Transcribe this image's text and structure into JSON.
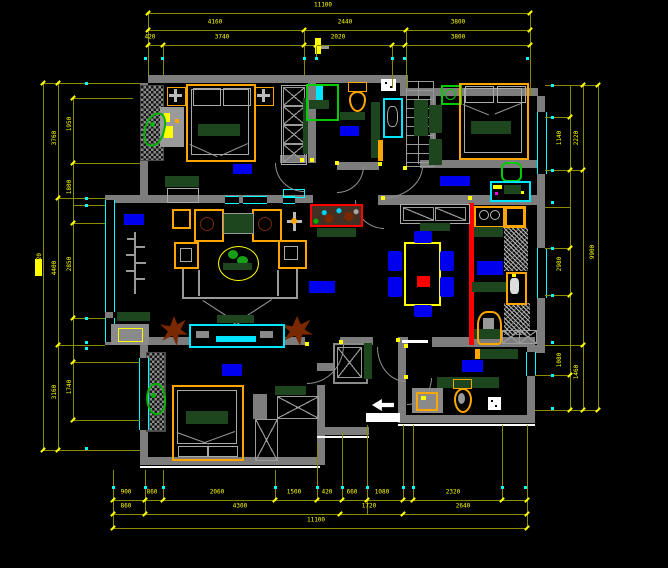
{
  "drawing": {
    "type": "residential floor plan (CAD)",
    "background": "#000000",
    "colors": {
      "wall": "#7d7d7d",
      "dimension_line": "#8a8a00",
      "dimension_text": "#ffff00",
      "window": "#00ffff",
      "furniture_frame": "#ffa500",
      "counter_green": "#1e461e",
      "label_block": "#0000ee",
      "accent_red": "#ff0000",
      "shower_green": "#00cc00",
      "chair_blue": "#0000ee",
      "plant_brown": "#7a2800"
    },
    "dimension_labels": [
      {
        "t": "11100",
        "x": 323,
        "y": 9,
        "v": false
      },
      {
        "t": "4160",
        "x": 215,
        "y": 26,
        "v": false
      },
      {
        "t": "2440",
        "x": 345,
        "y": 26,
        "v": false
      },
      {
        "t": "3800",
        "x": 458,
        "y": 26,
        "v": false
      },
      {
        "t": "420",
        "x": 150,
        "y": 41,
        "v": false
      },
      {
        "t": "3740",
        "x": 222,
        "y": 41,
        "v": false
      },
      {
        "t": "2020",
        "x": 338,
        "y": 41,
        "v": false
      },
      {
        "t": "3800",
        "x": 458,
        "y": 41,
        "v": false
      },
      {
        "t": "900",
        "x": 126,
        "y": 496,
        "v": false
      },
      {
        "t": "860",
        "x": 152,
        "y": 496,
        "v": false
      },
      {
        "t": "2060",
        "x": 217,
        "y": 496,
        "v": false
      },
      {
        "t": "1500",
        "x": 294,
        "y": 496,
        "v": false
      },
      {
        "t": "420",
        "x": 327,
        "y": 496,
        "v": false
      },
      {
        "t": "660",
        "x": 352,
        "y": 496,
        "v": false
      },
      {
        "t": "1080",
        "x": 382,
        "y": 496,
        "v": false
      },
      {
        "t": "2320",
        "x": 453,
        "y": 496,
        "v": false
      },
      {
        "t": "860",
        "x": 126,
        "y": 510,
        "v": false
      },
      {
        "t": "4300",
        "x": 240,
        "y": 510,
        "v": false
      },
      {
        "t": "1720",
        "x": 369,
        "y": 510,
        "v": false
      },
      {
        "t": "2640",
        "x": 463,
        "y": 510,
        "v": false
      },
      {
        "t": "11100",
        "x": 316,
        "y": 524,
        "v": false
      },
      {
        "t": "11320",
        "x": 40,
        "y": 262,
        "v": true
      },
      {
        "t": "3760",
        "x": 55,
        "y": 138,
        "v": true
      },
      {
        "t": "4400",
        "x": 55,
        "y": 268,
        "v": true
      },
      {
        "t": "3160",
        "x": 55,
        "y": 392,
        "v": true
      },
      {
        "t": "1950",
        "x": 70,
        "y": 124,
        "v": true
      },
      {
        "t": "1800",
        "x": 70,
        "y": 187,
        "v": true
      },
      {
        "t": "2850",
        "x": 70,
        "y": 264,
        "v": true
      },
      {
        "t": "1740",
        "x": 70,
        "y": 387,
        "v": true
      },
      {
        "t": "1140",
        "x": 560,
        "y": 138,
        "v": true
      },
      {
        "t": "2980",
        "x": 560,
        "y": 264,
        "v": true
      },
      {
        "t": "1080",
        "x": 560,
        "y": 360,
        "v": true
      },
      {
        "t": "2220",
        "x": 577,
        "y": 138,
        "v": true
      },
      {
        "t": "1460",
        "x": 577,
        "y": 372,
        "v": true
      },
      {
        "t": "9900",
        "x": 593,
        "y": 252,
        "v": true
      }
    ]
  }
}
